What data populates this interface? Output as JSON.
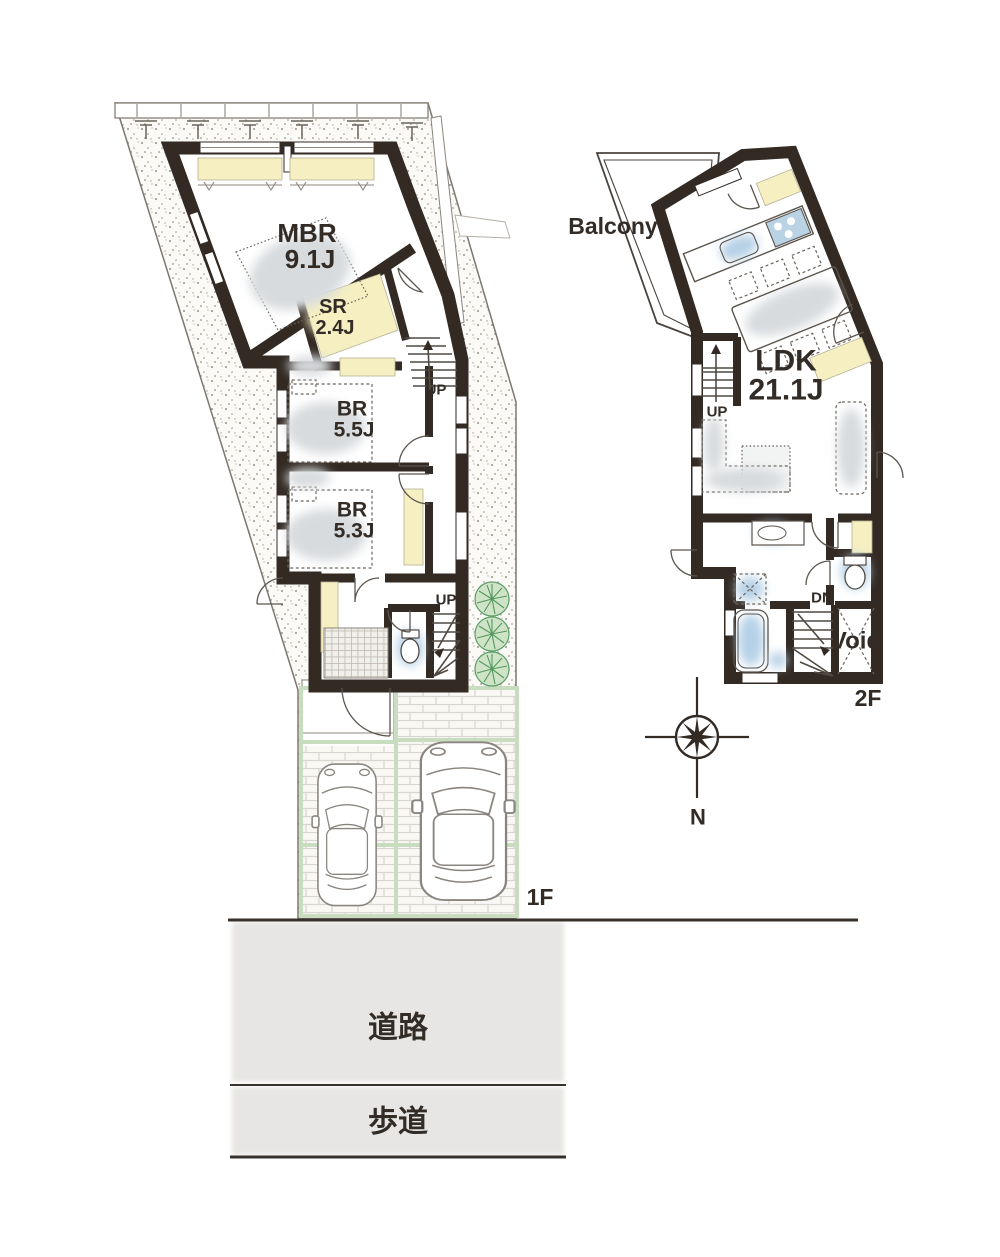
{
  "floor1": {
    "label": "1F",
    "rooms": [
      {
        "name": "MBR",
        "area": "9.1J"
      },
      {
        "name": "SR",
        "area": "2.4J"
      },
      {
        "name": "BR",
        "area": "5.5J"
      },
      {
        "name": "BR",
        "area": "5.3J"
      }
    ],
    "stairs": {
      "up1": "UP",
      "up2": "UP"
    }
  },
  "floor2": {
    "label": "2F",
    "ldk": {
      "name": "LDK",
      "area": "21.1J"
    },
    "balcony": "Balcony",
    "void": "Void",
    "stairs": {
      "up": "UP",
      "dn": "DN"
    }
  },
  "site": {
    "road": "道路",
    "sidewalk": "歩道"
  },
  "compass": {
    "north": "N"
  },
  "colors": {
    "wall": "#332a24",
    "text": "#332c26",
    "closet_yellow": "#f5efc2",
    "water_blue": "#b5d0e6",
    "furniture_gray": "#d8dbde",
    "tree_green": "#5c9e68",
    "parking_line_green": "#c8dcc0",
    "road_gray": "#e7e6e4"
  }
}
